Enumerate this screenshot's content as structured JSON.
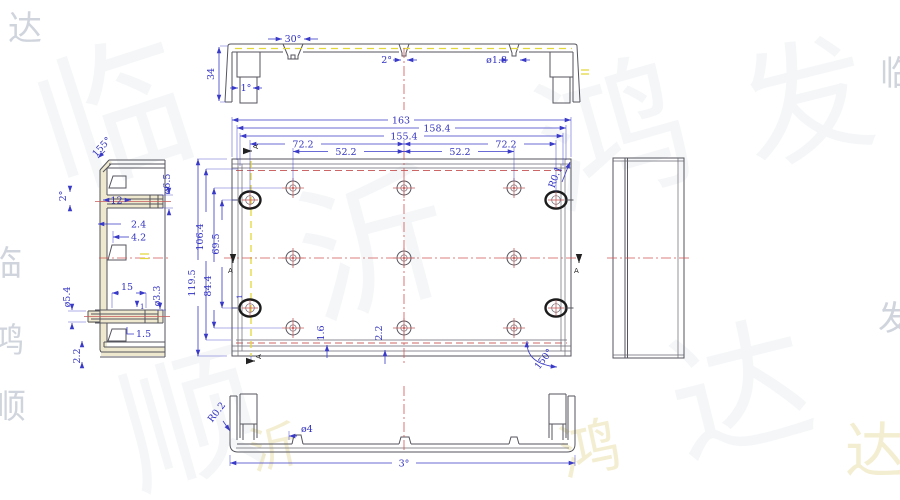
{
  "colors": {
    "dim_blue": "#3a3ac8",
    "line_gray": "#55555e",
    "center_red": "#d05555",
    "accent_yellow": "#e3d83a",
    "wall_cream": "#ece7cb",
    "boss_black": "#1c1c1c"
  },
  "sec_top": {
    "a30": "30°",
    "h34": "34",
    "a1": "1°",
    "a2": "2°",
    "d18": "ø1.8"
  },
  "plan": {
    "w163": "163",
    "w158": "158.4",
    "w155": "155.4",
    "w72l": "72.2",
    "w72r": "72.2",
    "w52l": "52.2",
    "w52r": "52.2",
    "h119": "119.5",
    "h106": "106.4",
    "h84": "84.4",
    "h69": "69.5",
    "t16": "1.6",
    "t22": "2.2",
    "t1": "1",
    "r01": "R0.1",
    "a150": "150°",
    "sec": "A"
  },
  "side": {
    "a155": "155°",
    "d65": "ø6.5",
    "a2": "2°",
    "w12": "12",
    "g24": "2.4",
    "g42": "4.2",
    "d54": "ø5.4",
    "w15": "15",
    "w1": "1",
    "d33": "ø3.3",
    "g15": "1.5",
    "g22": "2.2"
  },
  "sec_bot": {
    "r02": "R0.2",
    "d4": "ø4",
    "a3": "3°"
  },
  "watermark": {
    "chars": [
      "临",
      "沂",
      "鸿",
      "达",
      "顺",
      "发"
    ]
  }
}
